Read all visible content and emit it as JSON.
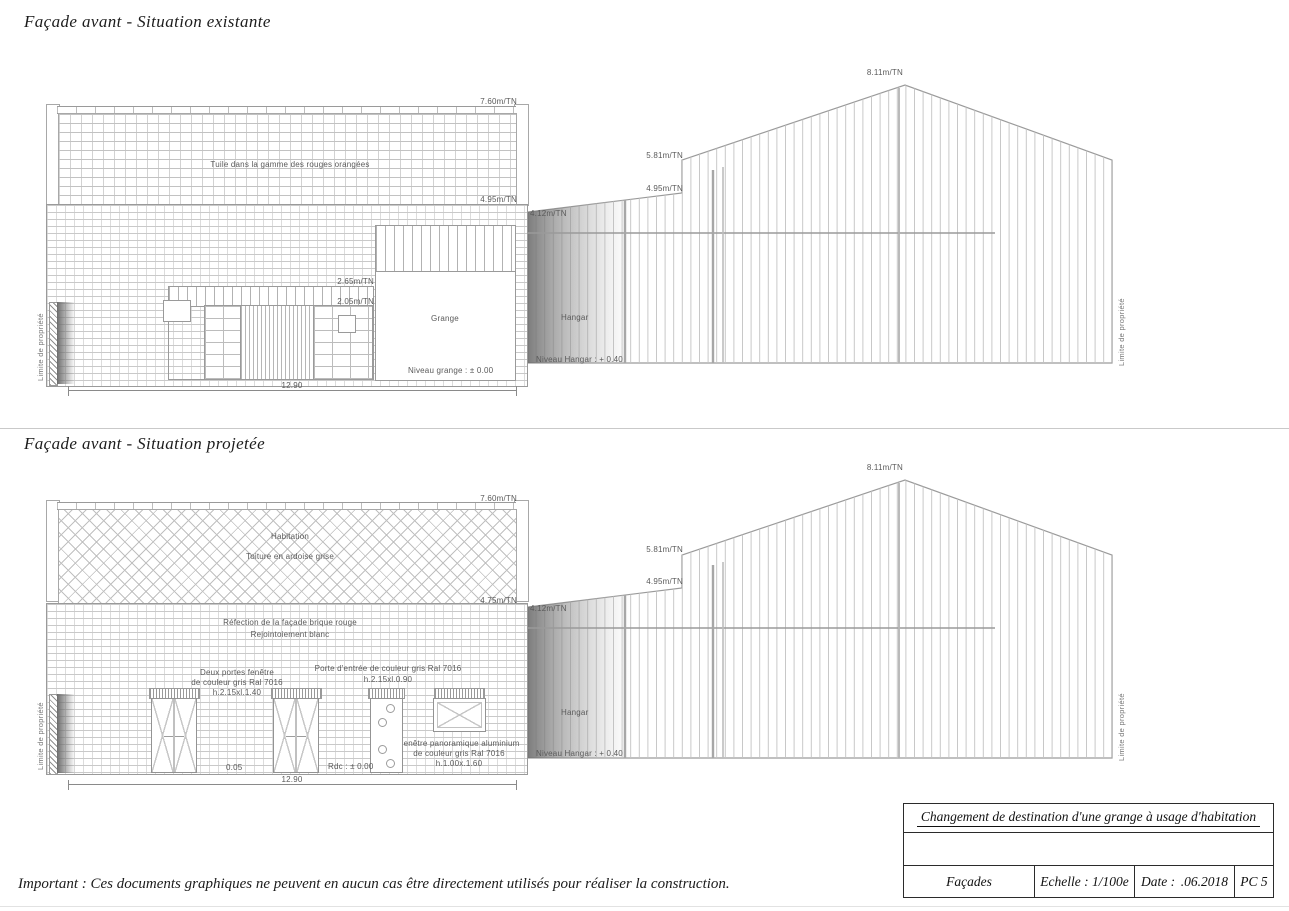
{
  "existing": {
    "title": "Façade avant - Situation existante",
    "house": {
      "roof_note": "Tuile dans la gamme des rouges orangées",
      "lv_760": "7.60m/TN",
      "lv_495": "4.95m/TN",
      "lv_265": "2.65m/TN",
      "lv_205": "2.05m/TN",
      "room": "Grange",
      "floor_note": "Niveau grange : ± 0.00",
      "dim": "12.90",
      "limit": "Limite de propriété"
    },
    "hangar": {
      "lv_412": "4.12m/TN",
      "lv_495": "4.95m/TN",
      "lv_581": "5.81m/TN",
      "lv_811": "8.11m/TN",
      "room": "Hangar",
      "floor_note": "Niveau Hangar : + 0.40",
      "limit": "Limite de propriété"
    }
  },
  "projected": {
    "title": "Façade avant - Situation projetée",
    "house": {
      "roof_note1": "Habitation",
      "roof_note2": "Toiture en ardoise grise",
      "lv_760": "7.60m/TN",
      "lv_475": "4.75m/TN",
      "facade_note1": "Réfection de la façade brique rouge",
      "facade_note2": "Rejointoiement blanc",
      "doors_note1": "Deux portes fenêtre",
      "doors_note2": "de couleur gris Ral 7016",
      "doors_note3": "h.2.15xl.1.40",
      "entry_note1": "Porte d'entrée de couleur gris Ral 7016",
      "entry_note2": "h.2.15xl.0.90",
      "window_note1": "Fenêtre panoramique aluminium",
      "window_note2": "de couleur gris Ral 7016",
      "window_note3": "h.1.00x.1.60",
      "lv_005": "0.05",
      "lv_rdc": "Rdc : ± 0.00",
      "dim": "12.90",
      "limit": "Limite de propriété"
    },
    "hangar": {
      "lv_412": "4.12m/TN",
      "lv_495": "4.95m/TN",
      "lv_581": "5.81m/TN",
      "lv_811": "8.11m/TN",
      "room": "Hangar",
      "floor_note": "Niveau Hangar : + 0.40",
      "limit": "Limite de propriété"
    }
  },
  "title_block": {
    "project": "Changement de destination d'une grange à usage d'habitation",
    "sheet": "Façades",
    "scale": "Echelle : 1/100e",
    "date_label": "Date :",
    "date_value": ".06.2018",
    "number": "PC 5"
  },
  "disclaimer": "Important : Ces documents graphiques ne peuvent en aucun cas être directement utilisés pour réaliser la construction."
}
